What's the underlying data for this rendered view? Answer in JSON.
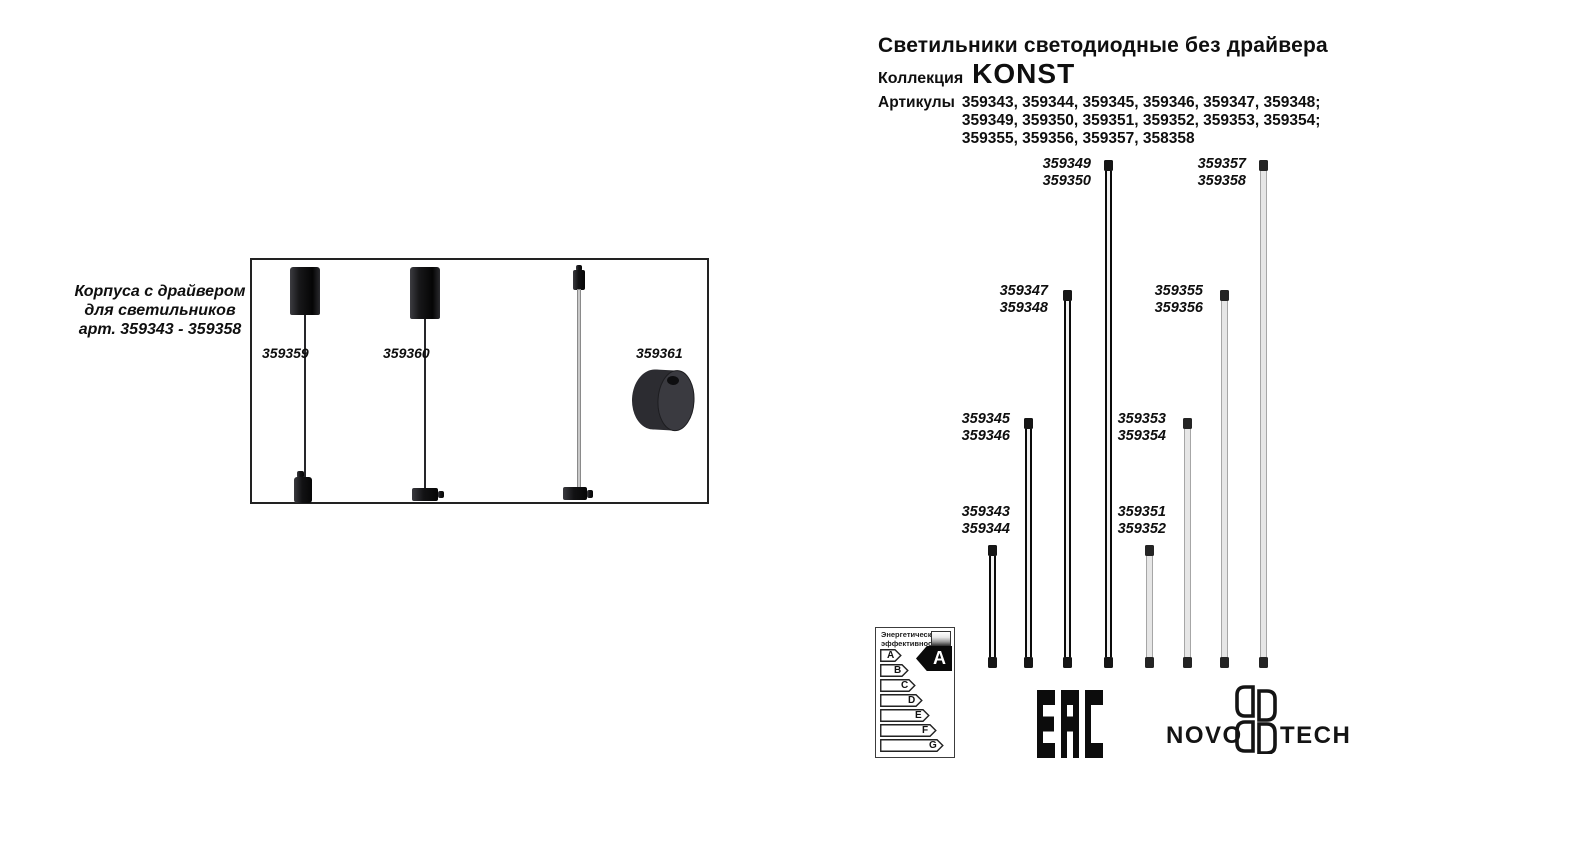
{
  "left_panel": {
    "caption": [
      "Корпуса с драйвером",
      "для светильников",
      "арт. 359343 - 359358"
    ],
    "items": [
      {
        "article": "359359"
      },
      {
        "article": "359360"
      },
      {
        "article": "359361"
      }
    ]
  },
  "header": {
    "title": "Светильники светодиодные без драйвера",
    "collection_label": "Коллекция",
    "collection_name": "KONST",
    "articles_label": "Артикулы",
    "articles_lines": [
      "359343, 359344, 359345, 359346, 359347, 359348;",
      "359349, 359350, 359351, 359352, 359353, 359354;",
      "359355, 359356, 359357, 358358"
    ]
  },
  "diagram": {
    "tube_groups": [
      {
        "line1": "359343",
        "line2": "359344",
        "color": "black",
        "size": "short"
      },
      {
        "line1": "359345",
        "line2": "359346",
        "color": "black",
        "size": "medium"
      },
      {
        "line1": "359347",
        "line2": "359348",
        "color": "black",
        "size": "tall"
      },
      {
        "line1": "359349",
        "line2": "359350",
        "color": "black",
        "size": "tallest"
      },
      {
        "line1": "359351",
        "line2": "359352",
        "color": "white",
        "size": "short"
      },
      {
        "line1": "359353",
        "line2": "359354",
        "color": "white",
        "size": "medium"
      },
      {
        "line1": "359355",
        "line2": "359356",
        "color": "white",
        "size": "tall"
      },
      {
        "line1": "359357",
        "line2": "359358",
        "color": "white",
        "size": "tallest"
      }
    ]
  },
  "energy_label": {
    "header_line1": "Энергетическая",
    "header_line2": "эффективность",
    "classes": [
      "A",
      "B",
      "C",
      "D",
      "E",
      "F",
      "G"
    ],
    "rating": "A"
  },
  "logos": {
    "eac": "EAC",
    "brand_left": "NOVO",
    "brand_right": "TECH"
  }
}
